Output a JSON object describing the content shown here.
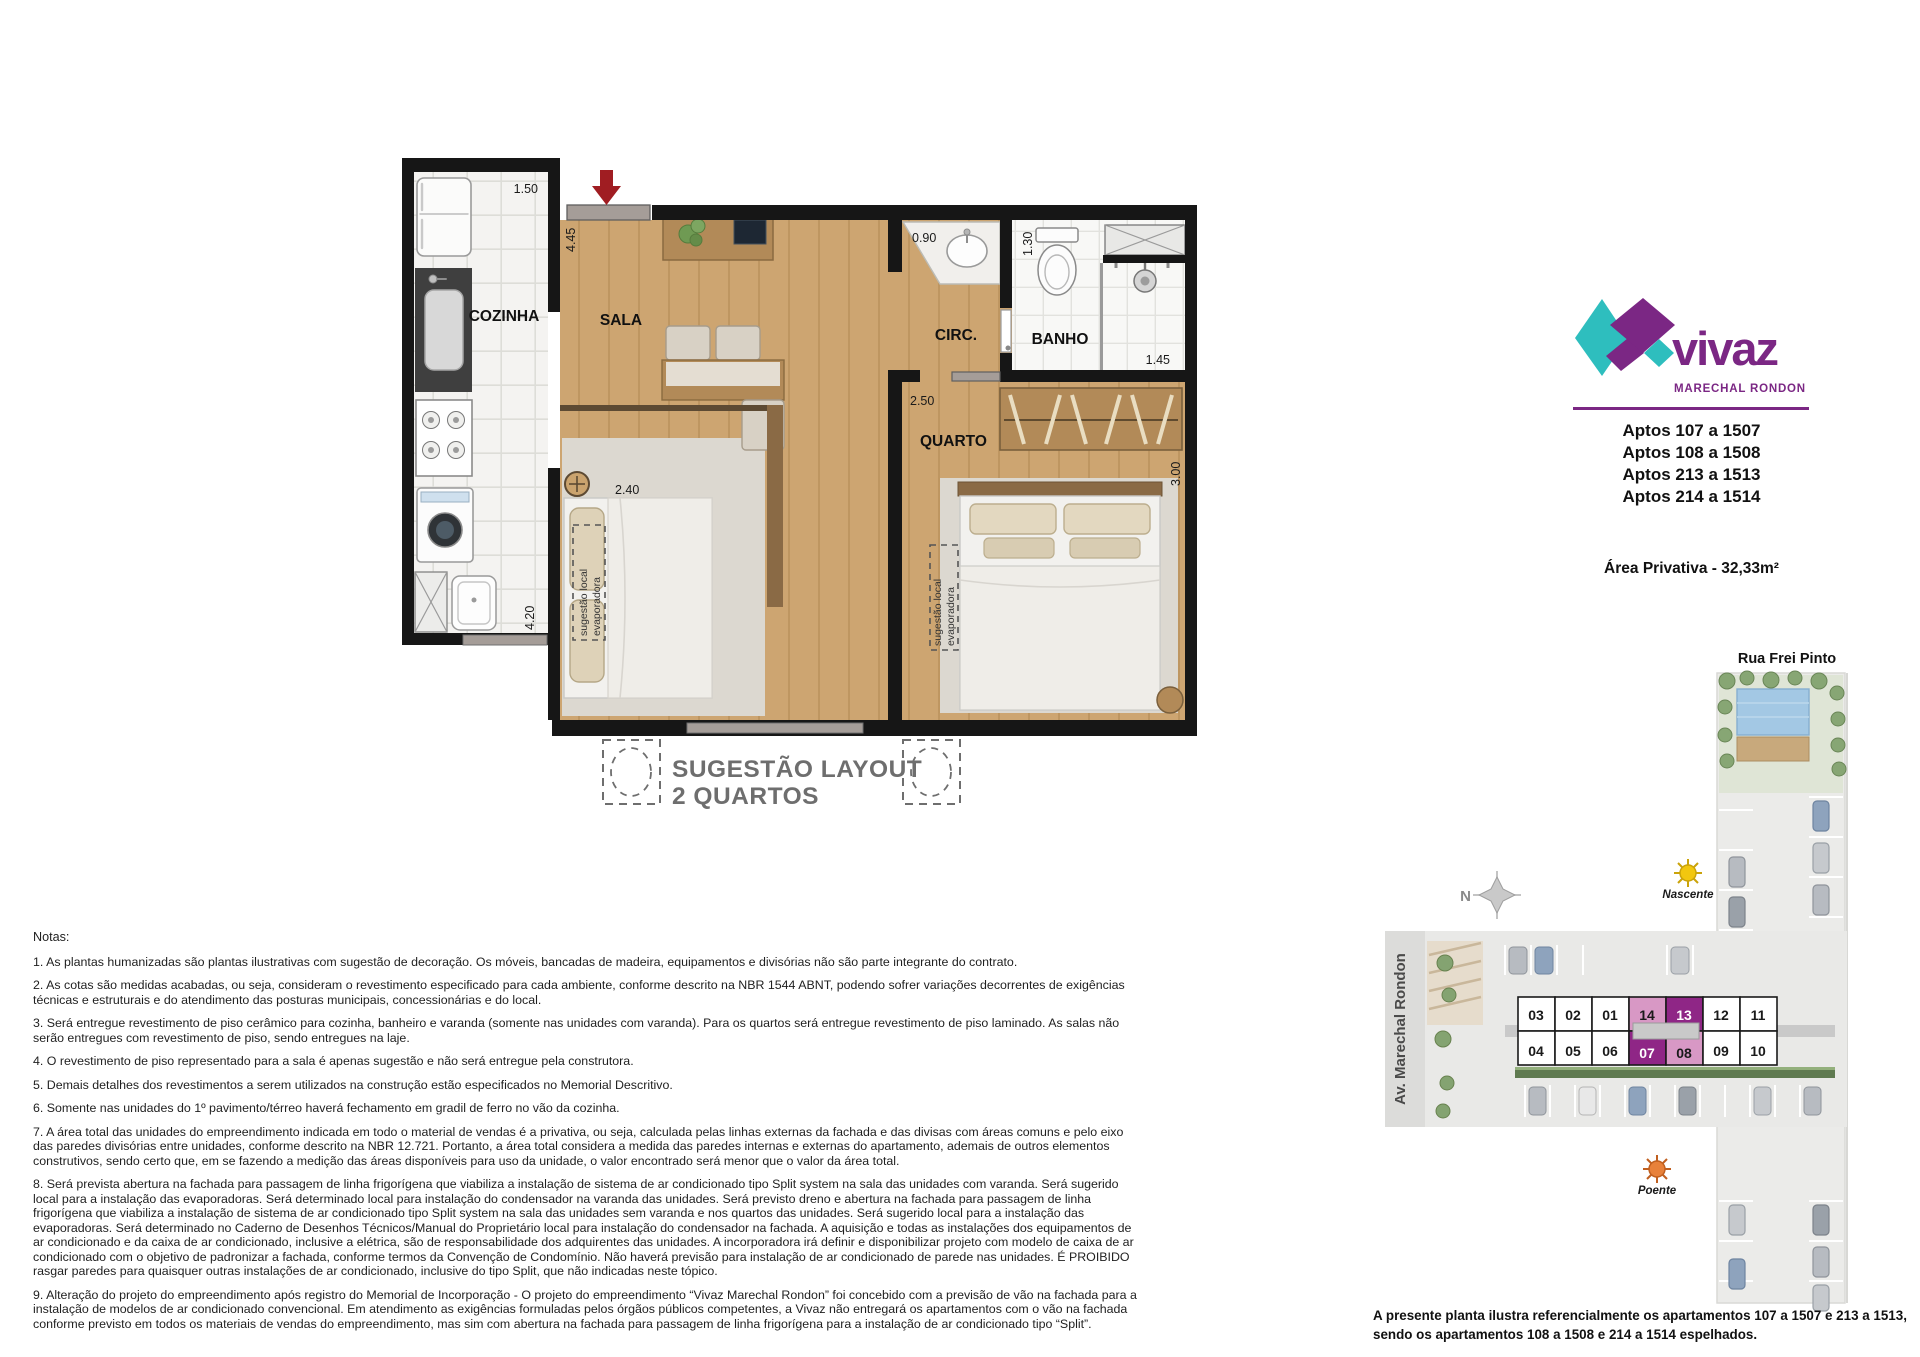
{
  "floor_plan": {
    "rooms": {
      "kitchen": "COZINHA",
      "living": "SALA",
      "circulation": "CIRC.",
      "bathroom": "BANHO",
      "bedroom": "QUARTO"
    },
    "dims": {
      "kitchen_top": "1.50",
      "living_side": "4.45",
      "kitchen_side": "4.20",
      "suggested_bed": "2.40",
      "bath_counter": "0.90",
      "toilet": "1.30",
      "shower": "1.45",
      "bedroom_top": "2.50",
      "bedroom_side": "3.00"
    },
    "evaporator": {
      "line1": "sugestão local",
      "line2": "evaporadora"
    },
    "suggestion": {
      "title": "SUGESTÃO LAYOUT",
      "subtitle": "2 QUARTOS"
    }
  },
  "brand": {
    "name": "vivaz",
    "location": "MARECHAL RONDON",
    "colors": {
      "teal": "#2EBEBE",
      "purple": "#7B2784"
    }
  },
  "apartments": {
    "lines": [
      "Aptos 107 a 1507",
      "Aptos 108 a 1508",
      "Aptos 213 a 1513",
      "Aptos 214 a 1514"
    ],
    "area": "Área Privativa - 32,33m²"
  },
  "site_plan": {
    "street_top": "Rua Frei Pinto",
    "street_left": "Av. Marechal Rondon",
    "compass_n": "N",
    "sun_east": "Nascente",
    "sun_west": "Poente",
    "units_top": [
      "03",
      "02",
      "01",
      "14",
      "13",
      "12",
      "11"
    ],
    "units_bottom": [
      "04",
      "05",
      "06",
      "07",
      "08",
      "09",
      "10"
    ],
    "highlight_dark_units": [
      "13",
      "07"
    ],
    "highlight_light_units": [
      "14",
      "08"
    ],
    "highlight_dark_color": "#8F2686",
    "highlight_light_color": "#D898C5",
    "disclaimer_line1": "A presente planta ilustra referencialmente os apartamentos 107 a 1507 e 213 a 1513,",
    "disclaimer_line2": "sendo os apartamentos 108 a 1508 e 214 a 1514 espelhados."
  },
  "notes": {
    "heading": "Notas:",
    "items": [
      "1. As plantas humanizadas são plantas ilustrativas com sugestão de decoração. Os móveis, bancadas de madeira, equipamentos e divisórias não são parte integrante do contrato.",
      "2. As cotas são medidas acabadas, ou seja, consideram o revestimento especificado para cada ambiente, conforme descrito na NBR 1544 ABNT, podendo sofrer variações decorrentes de exigências técnicas e estruturais e do atendimento das posturas municipais, concessionárias e do local.",
      "3. Será entregue revestimento de piso cerâmico para cozinha, banheiro e varanda (somente nas unidades com varanda). Para os quartos será entregue revestimento de piso laminado. As salas não serão entregues com revestimento de piso, sendo entregues na laje.",
      "4. O revestimento de piso representado para a sala é apenas sugestão e não será entregue pela construtora.",
      "5. Demais detalhes dos revestimentos a serem utilizados na construção estão especificados no Memorial Descritivo.",
      "6. Somente nas unidades do 1º pavimento/térreo haverá fechamento em gradil de ferro no vão da cozinha.",
      "7. A área total das unidades do empreendimento indicada em todo o material de vendas é a privativa, ou seja, calculada pelas linhas externas da fachada e das divisas com áreas comuns e pelo eixo das paredes divisórias entre unidades, conforme descrito na NBR 12.721. Portanto, a área total considera a medida das paredes internas e externas do apartamento, ademais de outros elementos construtivos, sendo certo que, em se fazendo a medição das áreas disponíveis para uso da unidade, o valor encontrado será menor que o valor da área total.",
      "8. Será prevista abertura na fachada para passagem de linha frigorígena que viabiliza a instalação de sistema de ar condicionado tipo Split system na sala das unidades com varanda. Será sugerido local para a instalação das evaporadoras. Será determinado local para instalação do condensador na varanda das unidades. Será previsto dreno e abertura na fachada para passagem de linha frigorígena que viabiliza a instalação de sistema de ar condicionado tipo Split system na sala das unidades sem varanda e nos quartos das unidades. Será sugerido local para a instalação das evaporadoras. Será determinado no Caderno de Desenhos Técnicos/Manual do Proprietário local para instalação do condensador na fachada. A aquisição e todas as instalações dos equipamentos de ar condicionado e da caixa de ar condicionado, inclusive a elétrica, são de responsabilidade dos adquirentes das unidades. A incorporadora irá definir e disponibilizar projeto com modelo de caixa de ar condicionado com o objetivo de padronizar a fachada, conforme termos da Convenção de Condomínio. Não haverá previsão para instalação de ar condicionado de parede nas unidades. É PROIBIDO rasgar paredes para quaisquer outras instalações de ar condicionado, inclusive do tipo Split, que não indicadas neste tópico.",
      "9. Alteração do projeto do empreendimento após registro do Memorial de Incorporação - O projeto do empreendimento “Vivaz Marechal Rondon” foi concebido com a previsão de vão na fachada para a instalação de modelos de ar condicionado convencional. Em atendimento as exigências formuladas pelos órgãos públicos competentes, a Vivaz não entregará os apartamentos com o vão na fachada conforme previsto em todos os materiais de vendas do empreendimento, mas sim com abertura na fachada para passagem de linha frigorígena para a instalação de ar condicionado tipo “Split”."
    ]
  }
}
